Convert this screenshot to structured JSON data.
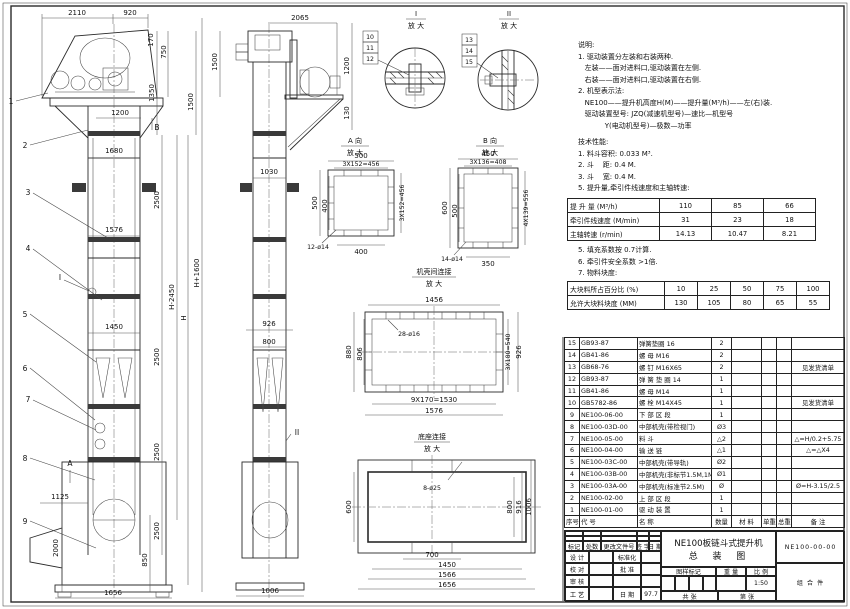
{
  "doc": {
    "type_label": "总装图(装配图)",
    "frame_color": "#2a2a2a"
  },
  "notes": {
    "title": "说明:",
    "lines": [
      "1. 驱动装置分左装和右装两种.",
      "   左装——面对进料口,驱动装置在左侧.",
      "   右装——面对进料口,驱动装置在右侧.",
      "2. 机型表示法:",
      "   NE100——提升机高度H(M)——提升量(M³/h)——左(右)装.",
      "   驱动装置型号: JZQ(减速机型号)—速比—机型号",
      "            Y(电动机型号)—极数—功率"
    ]
  },
  "tech": {
    "title": "技术性能:",
    "lines1": [
      "1. 料斗容积: 0.033 M³.",
      "2. 斗    距: 0.4 M.",
      "3. 斗    宽: 0.4 M.",
      "5. 提升量,牵引件线速度和主轴转速:"
    ],
    "table1": {
      "rows": [
        [
          "提 升 量  (M³/h)",
          "110",
          "85",
          "66"
        ],
        [
          "牵引件线速度 (M/min)",
          "31",
          "23",
          "18"
        ],
        [
          "主轴转速 (r/min)",
          "14.13",
          "10.47",
          "8.21"
        ]
      ]
    },
    "lines2": [
      "5. 填充系数按 0.7计算.",
      "6. 牵引件安全系数 >1倍.",
      "7. 物料块度:"
    ],
    "table2": {
      "rows": [
        [
          "大块料所占百分比 (%)",
          "10",
          "25",
          "50",
          "75",
          "100"
        ],
        [
          "允许大块料块度 (MM)",
          "130",
          "105",
          "80",
          "65",
          "55"
        ]
      ]
    }
  },
  "parts": {
    "headers": [
      "序号",
      "代  号",
      "名    称",
      "数量",
      "材  料",
      "单重",
      "总重",
      "备  注"
    ],
    "rows": [
      [
        "15",
        "GB93-87",
        "弹簧垫圈 16",
        "2",
        "",
        "",
        "",
        ""
      ],
      [
        "14",
        "GB41-86",
        "螺  母 M16",
        "2",
        "",
        "",
        "",
        ""
      ],
      [
        "13",
        "GB68-76",
        "螺  钉 M16X65",
        "2",
        "",
        "",
        "",
        "见发货清单"
      ],
      [
        "12",
        "GB93-87",
        "弹 簧 垫 圈 14",
        "1",
        "",
        "",
        "",
        ""
      ],
      [
        "11",
        "GB41-86",
        "螺  母 M14",
        "1",
        "",
        "",
        "",
        ""
      ],
      [
        "10",
        "GB5782-86",
        "螺  栓 M14X45",
        "1",
        "",
        "",
        "",
        "见发货清单"
      ],
      [
        "9",
        "NE100-06-00",
        "下 部 区 段",
        "1",
        "",
        "",
        "",
        ""
      ],
      [
        "8",
        "NE100-03D-00",
        "中部机壳(带检视门)",
        "Ø3",
        "",
        "",
        "",
        ""
      ],
      [
        "7",
        "NE100-05-00",
        "料  斗",
        "△2",
        "",
        "",
        "",
        "△=H/0.2+5.75"
      ],
      [
        "6",
        "NE100-04-00",
        "输 送 链",
        "△1",
        "",
        "",
        "",
        "△=△X4"
      ],
      [
        "5",
        "NE100-03C-00",
        "中部机壳(带导轨)",
        "Ø2",
        "",
        "",
        "",
        ""
      ],
      [
        "4",
        "NE100-03B-00",
        "中部机壳(非标节1.5M,1M)",
        "Ø1",
        "",
        "",
        "",
        ""
      ],
      [
        "3",
        "NE100-03A-00",
        "中部机壳(标准节2.5M)",
        "Ø",
        "",
        "",
        "",
        "Ø=H-3.15/2.5"
      ],
      [
        "2",
        "NE100-02-00",
        "上 部 区 段",
        "1",
        "",
        "",
        "",
        ""
      ],
      [
        "1",
        "NE100-01-00",
        "驱 动 装 置",
        "1",
        "",
        "",
        "",
        ""
      ]
    ]
  },
  "title_block": {
    "product": "NE100板链斗式提升机",
    "drawing": "总  装  图",
    "number": "NE100-00-00",
    "item_type": "组 合 件",
    "rev_headers": [
      "标记",
      "处数",
      "更改文件号",
      "签 字",
      "日 期"
    ],
    "row_design": "设 计",
    "row_check": "校 对",
    "row_audit": "审 核",
    "row_craft": "工 艺",
    "row_std": "标准化",
    "row_approve": "批 准",
    "row_date": "日 期",
    "date_value": "97.7",
    "stamp_headers": [
      "图样标记",
      "重 量",
      "比 例"
    ],
    "scale": "1:50",
    "sheet_total": "共  张",
    "sheet_no": "第  张"
  },
  "views": {
    "front": {
      "top1": "2110",
      "top2": "920",
      "r1": "170",
      "r2": "750",
      "r3": "1350",
      "r4": "1500",
      "w1": "1200",
      "w2": "1680",
      "w3": "1576",
      "w4": "1450",
      "s1": "2500",
      "s2": "2500",
      "s3": "2500",
      "s4": "2500",
      "h1": "H-2450",
      "h2": "H",
      "h3": "H+1600",
      "b1": "1125",
      "b2": "2000",
      "b3": "850",
      "b4": "1656",
      "leaders": [
        "1",
        "2",
        "3",
        "4",
        "5",
        "6",
        "7",
        "8",
        "9"
      ],
      "markerA": "A",
      "markerB": "B",
      "markerI": "I"
    },
    "side": {
      "top": "2065",
      "l1": "1500",
      "r1": "1200",
      "r2": "130",
      "w1": "1030",
      "w2": "926",
      "w3": "800",
      "b1": "1006",
      "markerII": "II"
    },
    "detail1": {
      "title": "I",
      "sub": "放 大",
      "tags": [
        "10",
        "11",
        "12"
      ]
    },
    "detail2": {
      "title": "II",
      "sub": "放 大",
      "tags": [
        "13",
        "14",
        "15"
      ]
    },
    "viewA": {
      "title": "A 向",
      "sub": "放 大",
      "top1": "500",
      "top2": "3X152=456",
      "left1": "500",
      "left2": "400",
      "right1": "3X152=456",
      "bot1": "400",
      "holes": "12-ø14"
    },
    "viewB": {
      "title": "B 向",
      "sub": "放 大",
      "top1": "450",
      "top2": "3X136=408",
      "left1": "600",
      "left2": "500",
      "right1": "4X139=556",
      "bot1": "350",
      "holes": "14-ø14"
    },
    "casing": {
      "title": "机壳间连接",
      "sub": "放 大",
      "top1": "1456",
      "left1": "880",
      "left2": "806",
      "right1": "3X180=540",
      "right2": "926",
      "bot1": "9X170=1530",
      "bot2": "1576",
      "holes": "28-ø16"
    },
    "base": {
      "title": "底座连接",
      "sub": "放 大",
      "left1": "600",
      "right1": "800",
      "right2": "916",
      "right3": "1006",
      "bot1": "700",
      "bot2": "1450",
      "bot3": "1566",
      "bot4": "1656",
      "holes": "8-ø25"
    }
  }
}
